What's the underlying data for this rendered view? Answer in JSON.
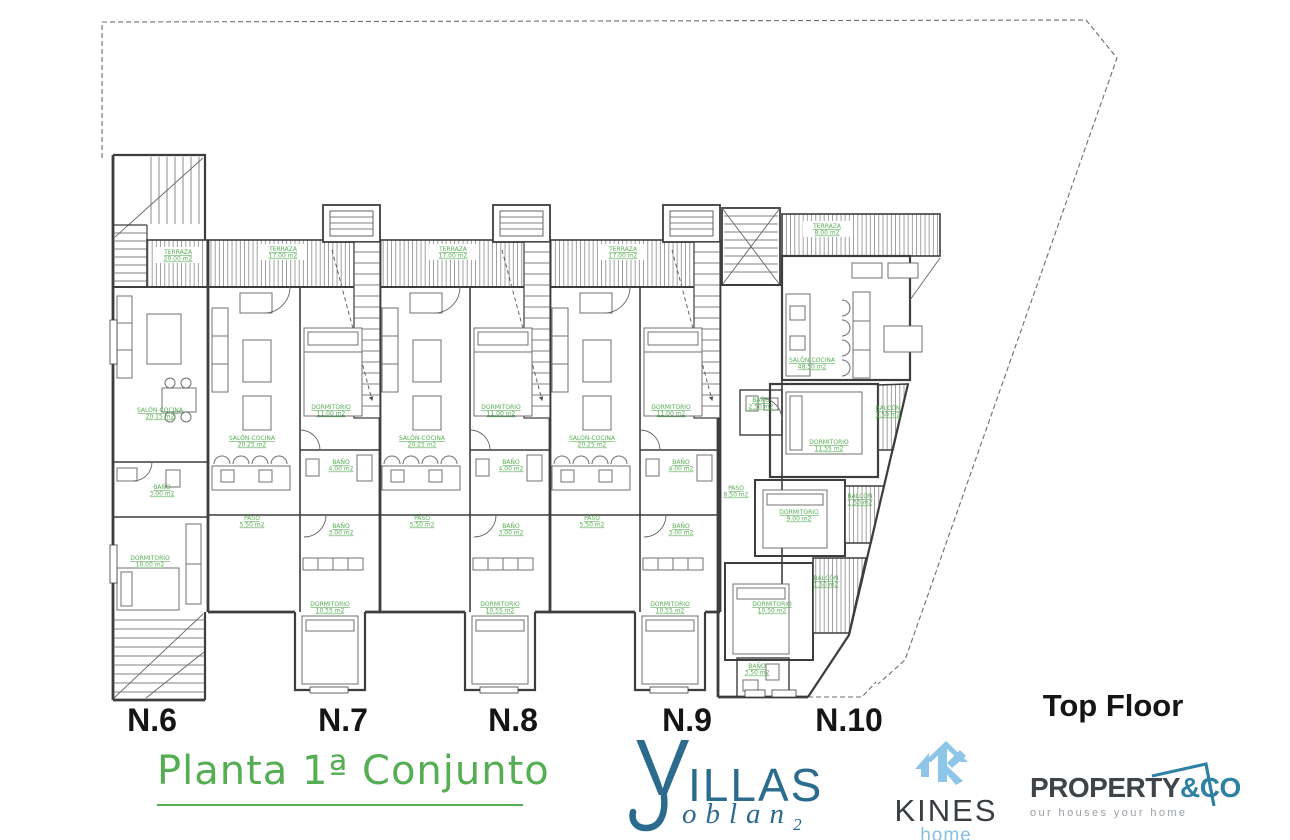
{
  "plan": {
    "line_color": "#3d3d3d",
    "label_color": "#56ae54",
    "floor_label": "Top Floor",
    "units": [
      {
        "label": "N.6"
      },
      {
        "label": "N.7"
      },
      {
        "label": "N.8"
      },
      {
        "label": "N.9"
      },
      {
        "label": "N.10"
      }
    ],
    "room_labels": [
      {
        "t": "TERRAZA",
        "a": "20.00 m2",
        "x": 178,
        "y": 254,
        "bg": true
      },
      {
        "t": "TERRAZA",
        "a": "17.00 m2",
        "x": 283,
        "y": 251,
        "bg": true
      },
      {
        "t": "TERRAZA",
        "a": "17.00 m2",
        "x": 453,
        "y": 251,
        "bg": true
      },
      {
        "t": "TERRAZA",
        "a": "17.00 m2",
        "x": 623,
        "y": 251,
        "bg": true
      },
      {
        "t": "TERRAZA",
        "a": "8.00 m2",
        "x": 827,
        "y": 228,
        "bg": true
      },
      {
        "t": "SALÓN-COCINA",
        "a": "20.15 m2",
        "x": 160,
        "y": 412
      },
      {
        "t": "SALÓN-COCINA",
        "a": "20.25 m2",
        "x": 252,
        "y": 440
      },
      {
        "t": "SALÓN-COCINA",
        "a": "20.25 m2",
        "x": 422,
        "y": 440
      },
      {
        "t": "SALÓN-COCINA",
        "a": "20.25 m2",
        "x": 592,
        "y": 440
      },
      {
        "t": "SALÓN-COCINA",
        "a": "48.50 m2",
        "x": 812,
        "y": 362
      },
      {
        "t": "DORMITORIO",
        "a": "11.00 m2",
        "x": 331,
        "y": 409
      },
      {
        "t": "DORMITORIO",
        "a": "11.00 m2",
        "x": 501,
        "y": 409
      },
      {
        "t": "DORMITORIO",
        "a": "11.00 m2",
        "x": 671,
        "y": 409
      },
      {
        "t": "BAÑO",
        "a": "4.00 m2",
        "x": 341,
        "y": 464
      },
      {
        "t": "BAÑO",
        "a": "4.00 m2",
        "x": 511,
        "y": 464
      },
      {
        "t": "BAÑO",
        "a": "4.00 m2",
        "x": 681,
        "y": 464
      },
      {
        "t": "BAÑO",
        "a": "3.00 m2",
        "x": 341,
        "y": 528
      },
      {
        "t": "BAÑO",
        "a": "3.00 m2",
        "x": 511,
        "y": 528
      },
      {
        "t": "BAÑO",
        "a": "3.00 m2",
        "x": 681,
        "y": 528
      },
      {
        "t": "PASO",
        "a": "5.50 m2",
        "x": 252,
        "y": 520
      },
      {
        "t": "PASO",
        "a": "5.50 m2",
        "x": 422,
        "y": 520
      },
      {
        "t": "PASO",
        "a": "5.50 m2",
        "x": 592,
        "y": 520
      },
      {
        "t": "DORMITORIO",
        "a": "10.55 m2",
        "x": 330,
        "y": 606
      },
      {
        "t": "DORMITORIO",
        "a": "10.55 m2",
        "x": 500,
        "y": 606
      },
      {
        "t": "DORMITORIO",
        "a": "10.55 m2",
        "x": 670,
        "y": 606
      },
      {
        "t": "BAÑO",
        "a": "3.00 m2",
        "x": 162,
        "y": 489
      },
      {
        "t": "DORMITORIO",
        "a": "10.00 m2",
        "x": 150,
        "y": 560
      },
      {
        "t": "BAÑO",
        "a": "2.50 m2",
        "x": 761,
        "y": 402
      },
      {
        "t": "DORMITORIO",
        "a": "11.55 m2",
        "x": 829,
        "y": 444
      },
      {
        "t": "BALCÓN",
        "a": "1.50 m2",
        "x": 888,
        "y": 410
      },
      {
        "t": "PASO",
        "a": "8.50 m2",
        "x": 736,
        "y": 490
      },
      {
        "t": "DORMITORIO",
        "a": "9.00 m2",
        "x": 799,
        "y": 514
      },
      {
        "t": "BALCÓN",
        "a": "1.50 m2",
        "x": 860,
        "y": 498
      },
      {
        "t": "DORMITORIO",
        "a": "10.50 m2",
        "x": 772,
        "y": 606
      },
      {
        "t": "BALCÓN",
        "a": "1.50 m2",
        "x": 826,
        "y": 580
      },
      {
        "t": "BAÑO",
        "a": "3.50 m2",
        "x": 757,
        "y": 668
      }
    ]
  },
  "title": {
    "text": "Planta 1ª Conjunto",
    "color": "#56ae54"
  },
  "logos": {
    "villas": {
      "v": "V",
      "illas": "ILLAS",
      "oblan": "oblan",
      "sub": "2",
      "color": "#2a6b8e"
    },
    "kines": {
      "name": "KINES",
      "home": "home",
      "icon_color": "#8ec6e9",
      "text_color": "#3a3e42"
    },
    "property": {
      "name_dark": "PROPERTY",
      "name_accent": "&CO",
      "tagline": "our houses your home",
      "accent_color": "#2f81a3"
    }
  }
}
